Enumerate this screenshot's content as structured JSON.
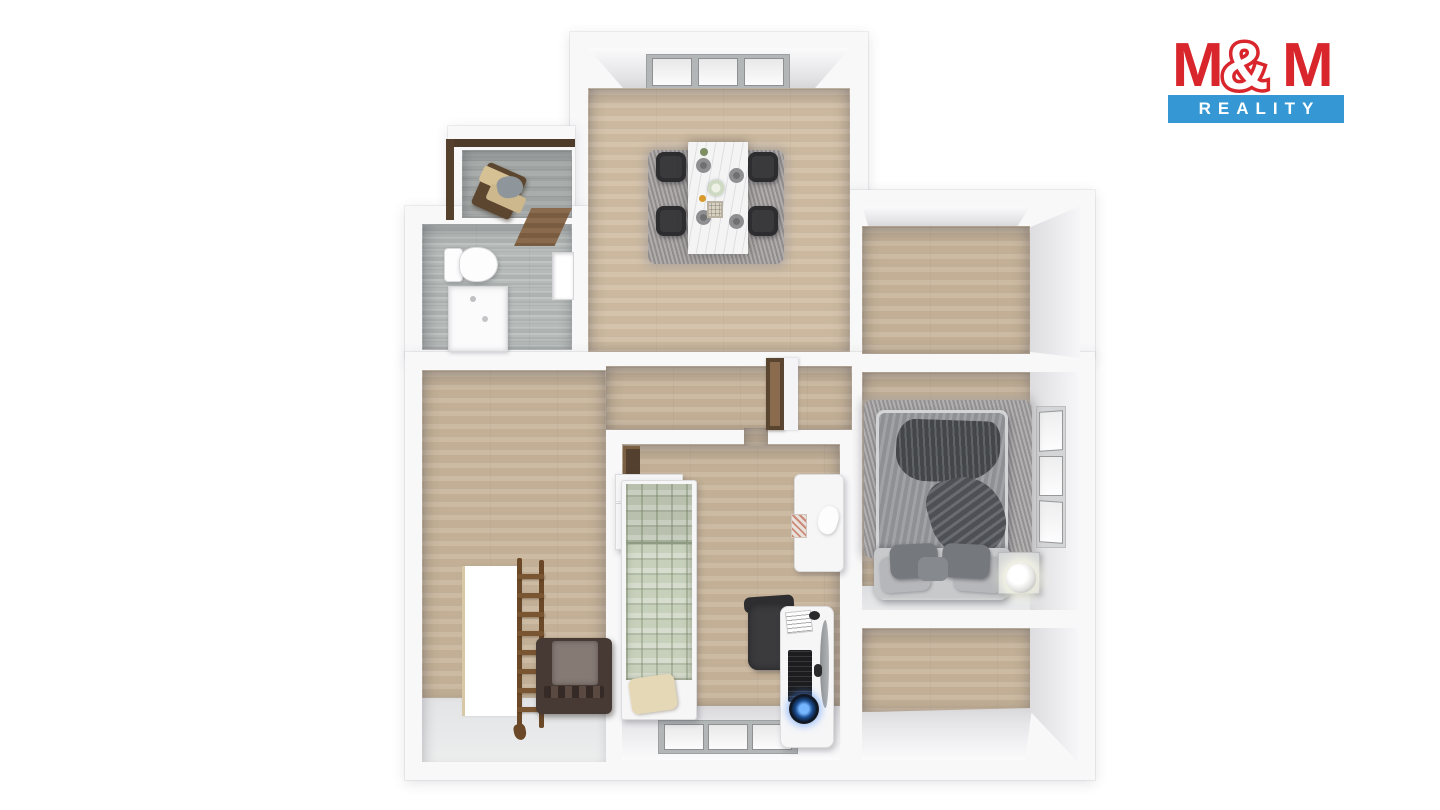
{
  "logo": {
    "m1": "M",
    "amp": "&",
    "m2": "M",
    "reality": "REALITY"
  },
  "theme": {
    "logo-red": "#d8262c",
    "logo-blue": "#3598d4",
    "wood": "#ccbaa2",
    "wood-dark": "#c2af95",
    "tile": "#b6bbb9",
    "rug": "#a3a0a1"
  }
}
